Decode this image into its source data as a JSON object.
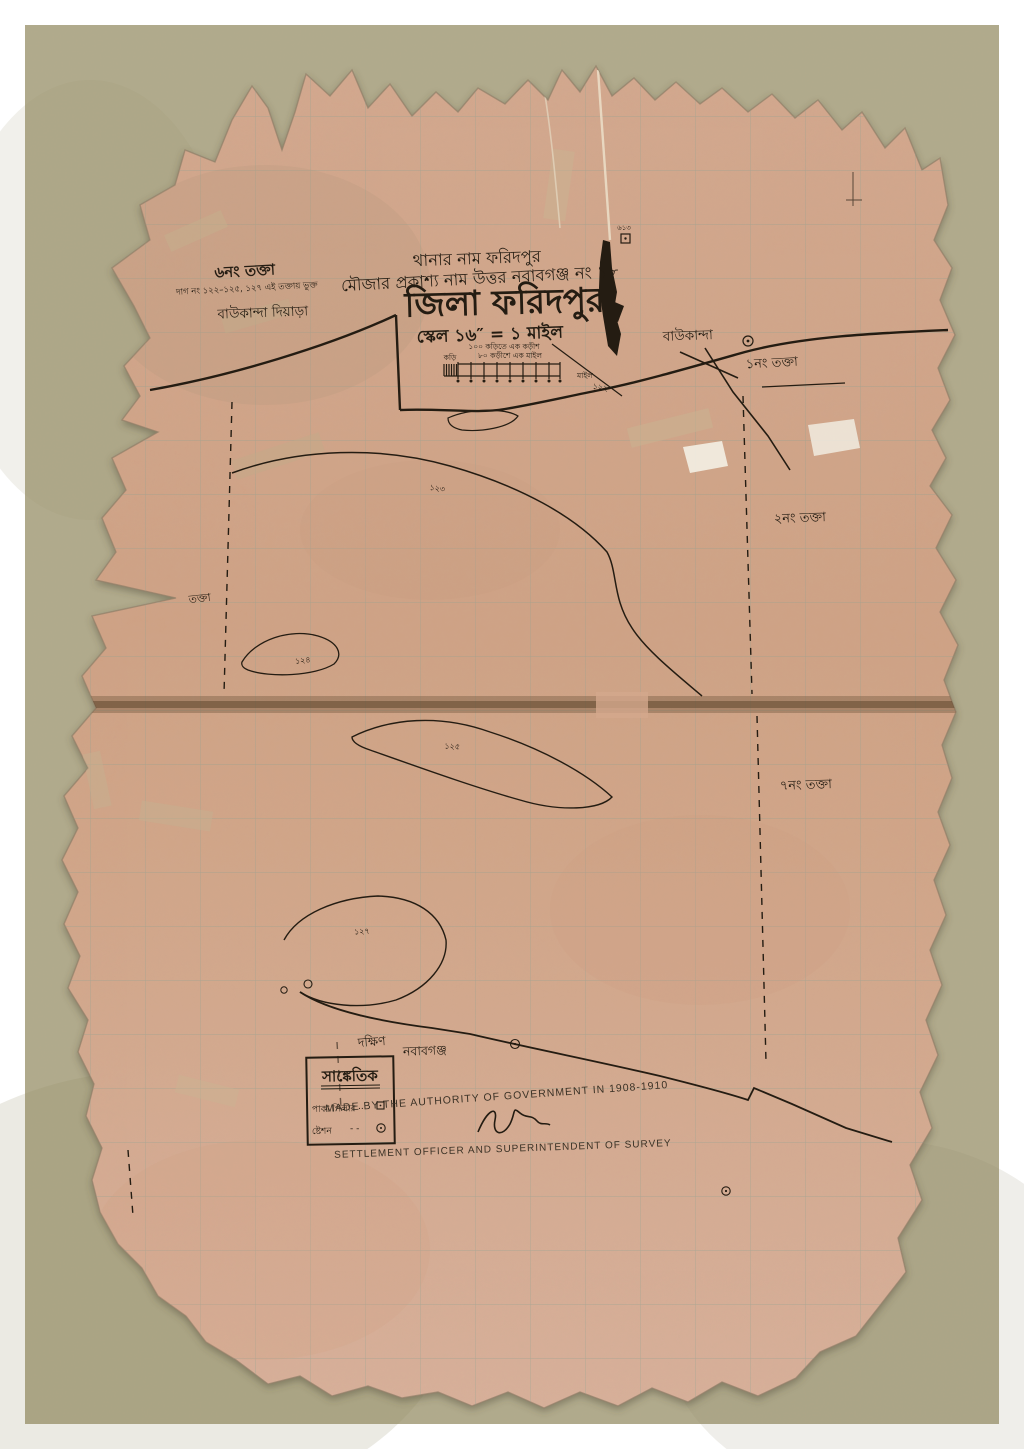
{
  "header": {
    "line1": "থানার নাম ফরিদপুর",
    "line2": "মৌজার প্রকাশ্য নাম উত্তর নবাবগঞ্জ নং ১৮",
    "title": "জিলা ফরিদপুর",
    "scale": "স্কেল ১৬″ = ১ মাইল"
  },
  "scale_bar": {
    "note1": "১০০ কড়িতে এক কড়ীশ",
    "note2": "৮০ কড়ীশে এক মাইল",
    "left_label": "কড়ি",
    "right_label": "মাইল"
  },
  "labels": {
    "sheet6": "৬নং তক্তা",
    "sheet6_note": "দাগ নং ১২২–১২৫, ১২৭ এই তক্তায় ভুক্ত",
    "baukanda_diyara": "বাউকান্দা দিয়াড়া",
    "baukanda": "বাউকান্দা",
    "sheet1": "১নং তক্তা",
    "sheet2": "২নং তক্তা",
    "sheet7": "৭নং তক্তা",
    "sheet_partial": "তক্তা",
    "dakshin": "দক্ষিণ",
    "nababganj": "নবাবগঞ্জ"
  },
  "plot_numbers": {
    "p122": "১২২",
    "p123": "১২৩",
    "p124": "১২৪",
    "p125": "১২৫",
    "p127": "১২৭",
    "station_no": "৬১৩"
  },
  "legend": {
    "title": "সাঙ্কেতিক",
    "rows": [
      {
        "label": "পাকা পিলার",
        "dots": "..",
        "symbol": "square"
      },
      {
        "label": "ষ্টেশন",
        "dots": "- -",
        "symbol": "circle"
      }
    ]
  },
  "footer": {
    "made_by": "MADE BY THE AUTHORITY OF GOVERNMENT IN 1908-1910",
    "officer": "SETTLEMENT OFFICER AND SUPERINTENDENT OF SURVEY"
  },
  "colors": {
    "frame": "#ffffff",
    "background": "#b1aa8b",
    "paper": "#d4a98e",
    "grid": "#8ba092",
    "ink": "#241c12",
    "stain_band": "#6b5138"
  }
}
